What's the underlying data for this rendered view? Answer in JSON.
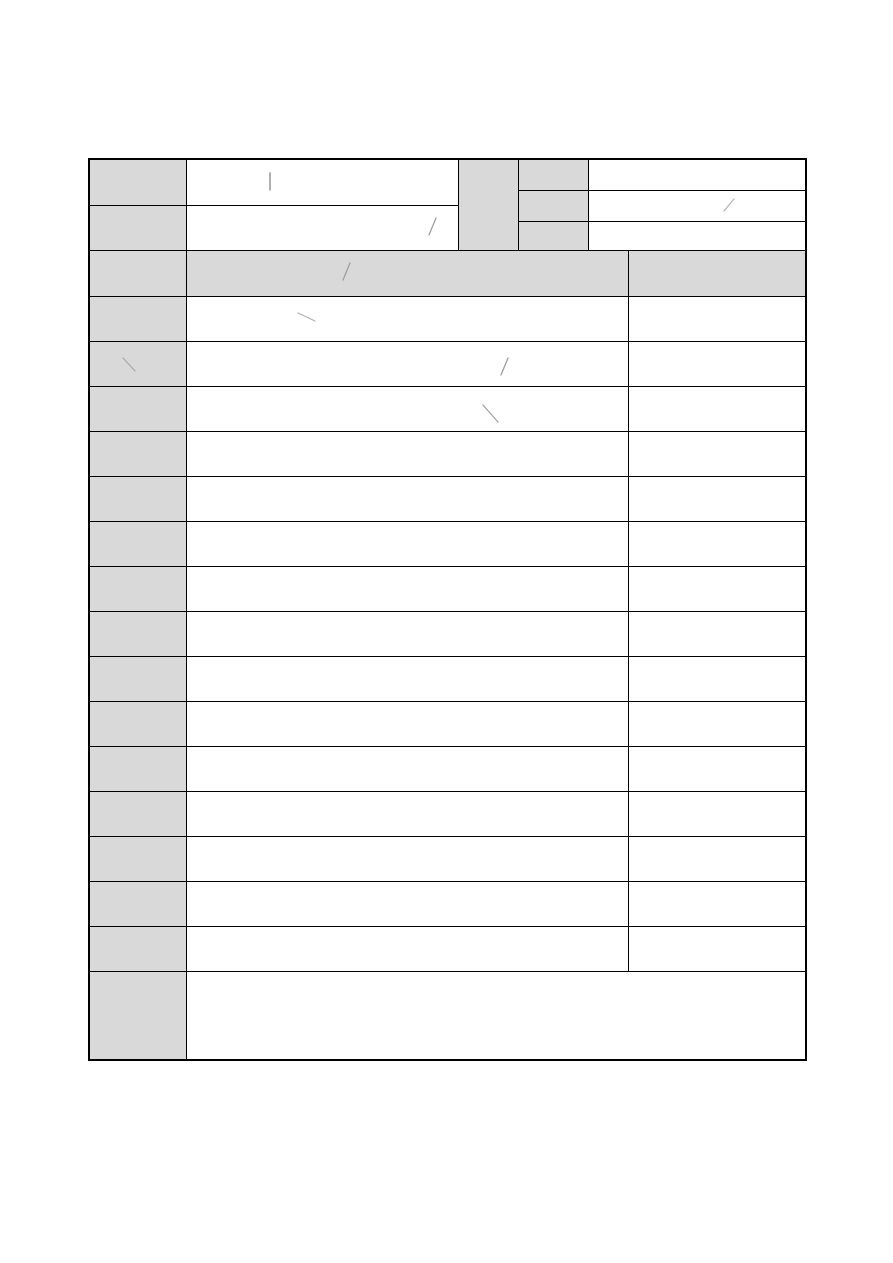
{
  "document": {
    "page_background": "#ffffff",
    "table": {
      "grid_color": "#000000",
      "shaded_cell_color": "#d9d9d9",
      "unshaded_cell_color": "#ffffff",
      "all_cells_empty": true
    },
    "stray_marks": [
      {
        "name": "stray-mark-vertical-header-value-a",
        "x1": 270,
        "y1": 173,
        "x2": 270,
        "y2": 190,
        "color": "#8f8f8f",
        "width": 1.4
      },
      {
        "name": "stray-mark-slash-header-sub-value-2",
        "x1": 734,
        "y1": 199,
        "x2": 724,
        "y2": 211,
        "color": "#b3b3b3",
        "width": 1.2
      },
      {
        "name": "stray-mark-slash-header-value-b",
        "x1": 436,
        "y1": 218,
        "x2": 429,
        "y2": 235,
        "color": "#9e9e9e",
        "width": 1.3
      },
      {
        "name": "stray-mark-slash-section-title",
        "x1": 350,
        "y1": 263,
        "x2": 343,
        "y2": 280,
        "color": "#9e9e9e",
        "width": 1.3
      },
      {
        "name": "stray-mark-backslash-row-4-value",
        "x1": 298,
        "y1": 313,
        "x2": 315,
        "y2": 321,
        "color": "#b0b0b0",
        "width": 1.2
      },
      {
        "name": "stray-mark-backslash-row-5-label",
        "x1": 123,
        "y1": 358,
        "x2": 135,
        "y2": 371,
        "color": "#a8a8a8",
        "width": 1.2
      },
      {
        "name": "stray-mark-slash-row-5-value",
        "x1": 508,
        "y1": 358,
        "x2": 501,
        "y2": 375,
        "color": "#9e9e9e",
        "width": 1.3
      },
      {
        "name": "stray-mark-backslash-row-6-value",
        "x1": 483,
        "y1": 405,
        "x2": 498,
        "y2": 422,
        "color": "#a3a3a3",
        "width": 1.3
      }
    ]
  }
}
